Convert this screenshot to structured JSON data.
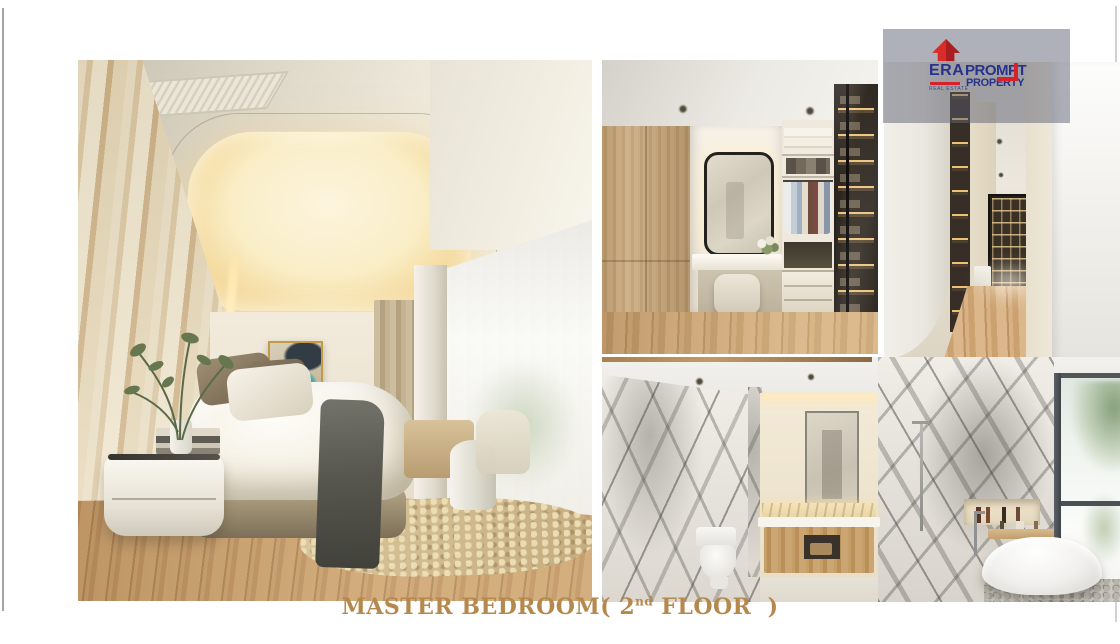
{
  "caption": {
    "part1": "MASTER BEDROOM( 2",
    "sup": "nd",
    "part2": "FLOOR )",
    "color": "#b5894e"
  },
  "logo": {
    "era": "ERA",
    "sub": "REAL ESTATE",
    "prompt": "PROMPT",
    "property": "PROPERTY",
    "navy": "#27338b",
    "red": "#d7212b"
  },
  "icons": {
    "era_house_icon": "red house / upward roof glyph"
  }
}
